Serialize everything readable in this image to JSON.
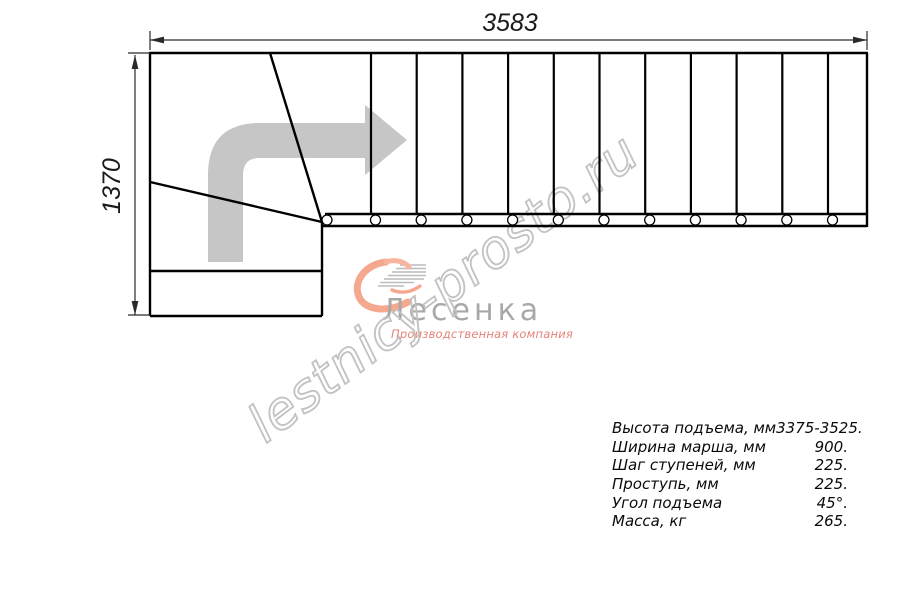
{
  "drawing": {
    "title": "staircase-top-view-plan",
    "dimensions": {
      "width_mm": "3583",
      "height_mm": "1370"
    },
    "step_count_straight": 12,
    "tread_bolts": 12
  },
  "watermark": {
    "text": "lestnicy-prosto.ru"
  },
  "logo": {
    "name": "Лесенка",
    "tagline": "Производственная компания"
  },
  "specs": {
    "rows": [
      {
        "label": "Высота подъема, мм",
        "value": "3375-3525."
      },
      {
        "label": "Ширина марша, мм",
        "value": "900."
      },
      {
        "label": "Шаг ступеней, мм",
        "value": "225."
      },
      {
        "label": "Проступь, мм",
        "value": "225."
      },
      {
        "label": "Угол подъема",
        "value": "45°."
      },
      {
        "label": "Масса, кг",
        "value": "265."
      }
    ]
  },
  "colors": {
    "line": "#000000",
    "dimension": "#2a2a2a",
    "direction_arrow": "#c6c6c6",
    "watermark": "#c2c2c2",
    "logo_text": "#a8a8a8",
    "logo_accent": "#f6a88e",
    "tagline": "#e5837b"
  }
}
